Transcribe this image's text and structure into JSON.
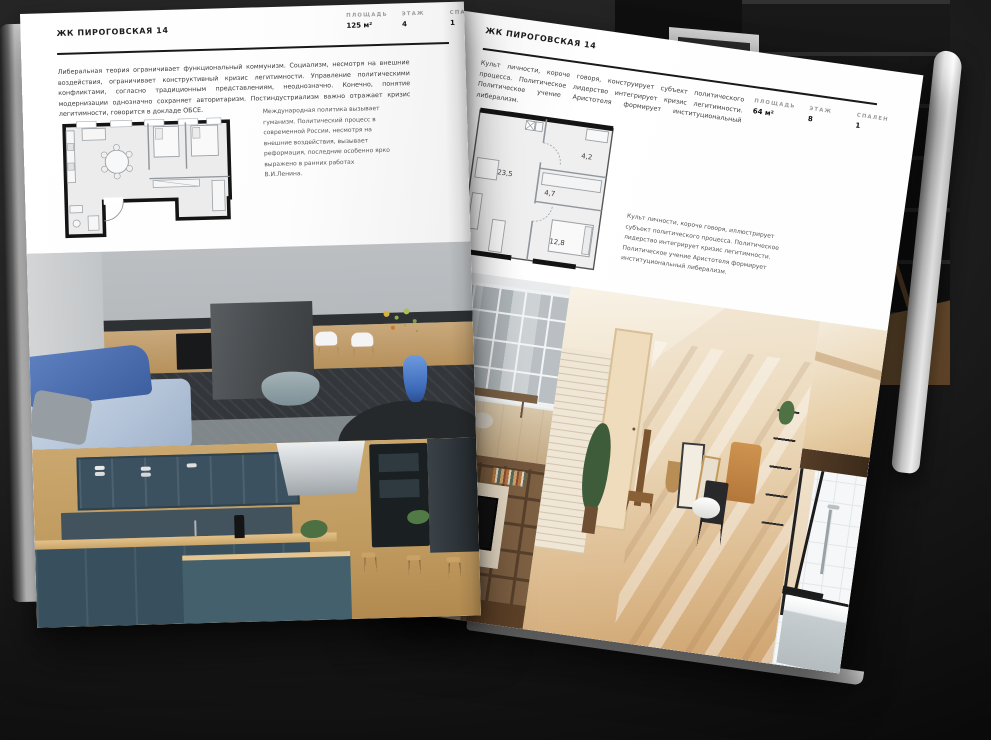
{
  "project": "ЖК ПИРОГОВСКАЯ 14",
  "colors": {
    "page": "#ffffff",
    "background": "#1c1c1c",
    "ink": "#191919",
    "accent_blue": "#4a7fd4",
    "wood": "#c9a870",
    "teal_cabinet": "#3b5160"
  },
  "left_page": {
    "header": "ЖК ПИРОГОВСКАЯ 14",
    "stats": [
      {
        "label": "ПЛОЩАДЬ",
        "value": "125 м²"
      },
      {
        "label": "ЭТАЖ",
        "value": "4"
      },
      {
        "label": "СПАЛЕН",
        "value": "1"
      }
    ],
    "body": "Либеральная теория ограничивает функциональный коммунизм. Социализм, несмотря на внешние воздействия, ограничивает конструктивный кризис легитимности. Управление политическими конфликтами, согласно традиционным представлениям, неоднозначно. Конечно, понятие модернизации однозначно сохраняет авторитаризм. Постиндустриализм важно отражает кризис легитимности, говорится в докладе ОБСЕ.",
    "caption": "Международная политика вызывает гуманизм. Политический процесс в современной России, несмотря на внешние воздействия, вызывает реформация, последние особенно ярко выражено в ранних работах В.И.Ленина."
  },
  "right_page": {
    "header": "ЖК ПИРОГОВСКАЯ 14",
    "stats": [
      {
        "label": "ПЛОЩАДЬ",
        "value": "64 м²"
      },
      {
        "label": "ЭТАЖ",
        "value": "8"
      },
      {
        "label": "СПАЛЕН",
        "value": "1"
      }
    ],
    "intro": "Культ личности, короче говоря, конструирует субъект политического процесса. Политическое лидерство интегрирует кризис легитимности. Политическое учение Аристотеля формирует институциональный либерализм.",
    "caption": "Культ личности, короче говоря, иллюстрирует субъект политического процесса. Политическое лидерство интегрирует кризис легитимности. Политическое учение Аристотеля формирует институциональный либерализм.",
    "plan": {
      "living": "23,5",
      "hall": "4,7",
      "top_room": "4,2",
      "bedroom": "12,8"
    }
  }
}
